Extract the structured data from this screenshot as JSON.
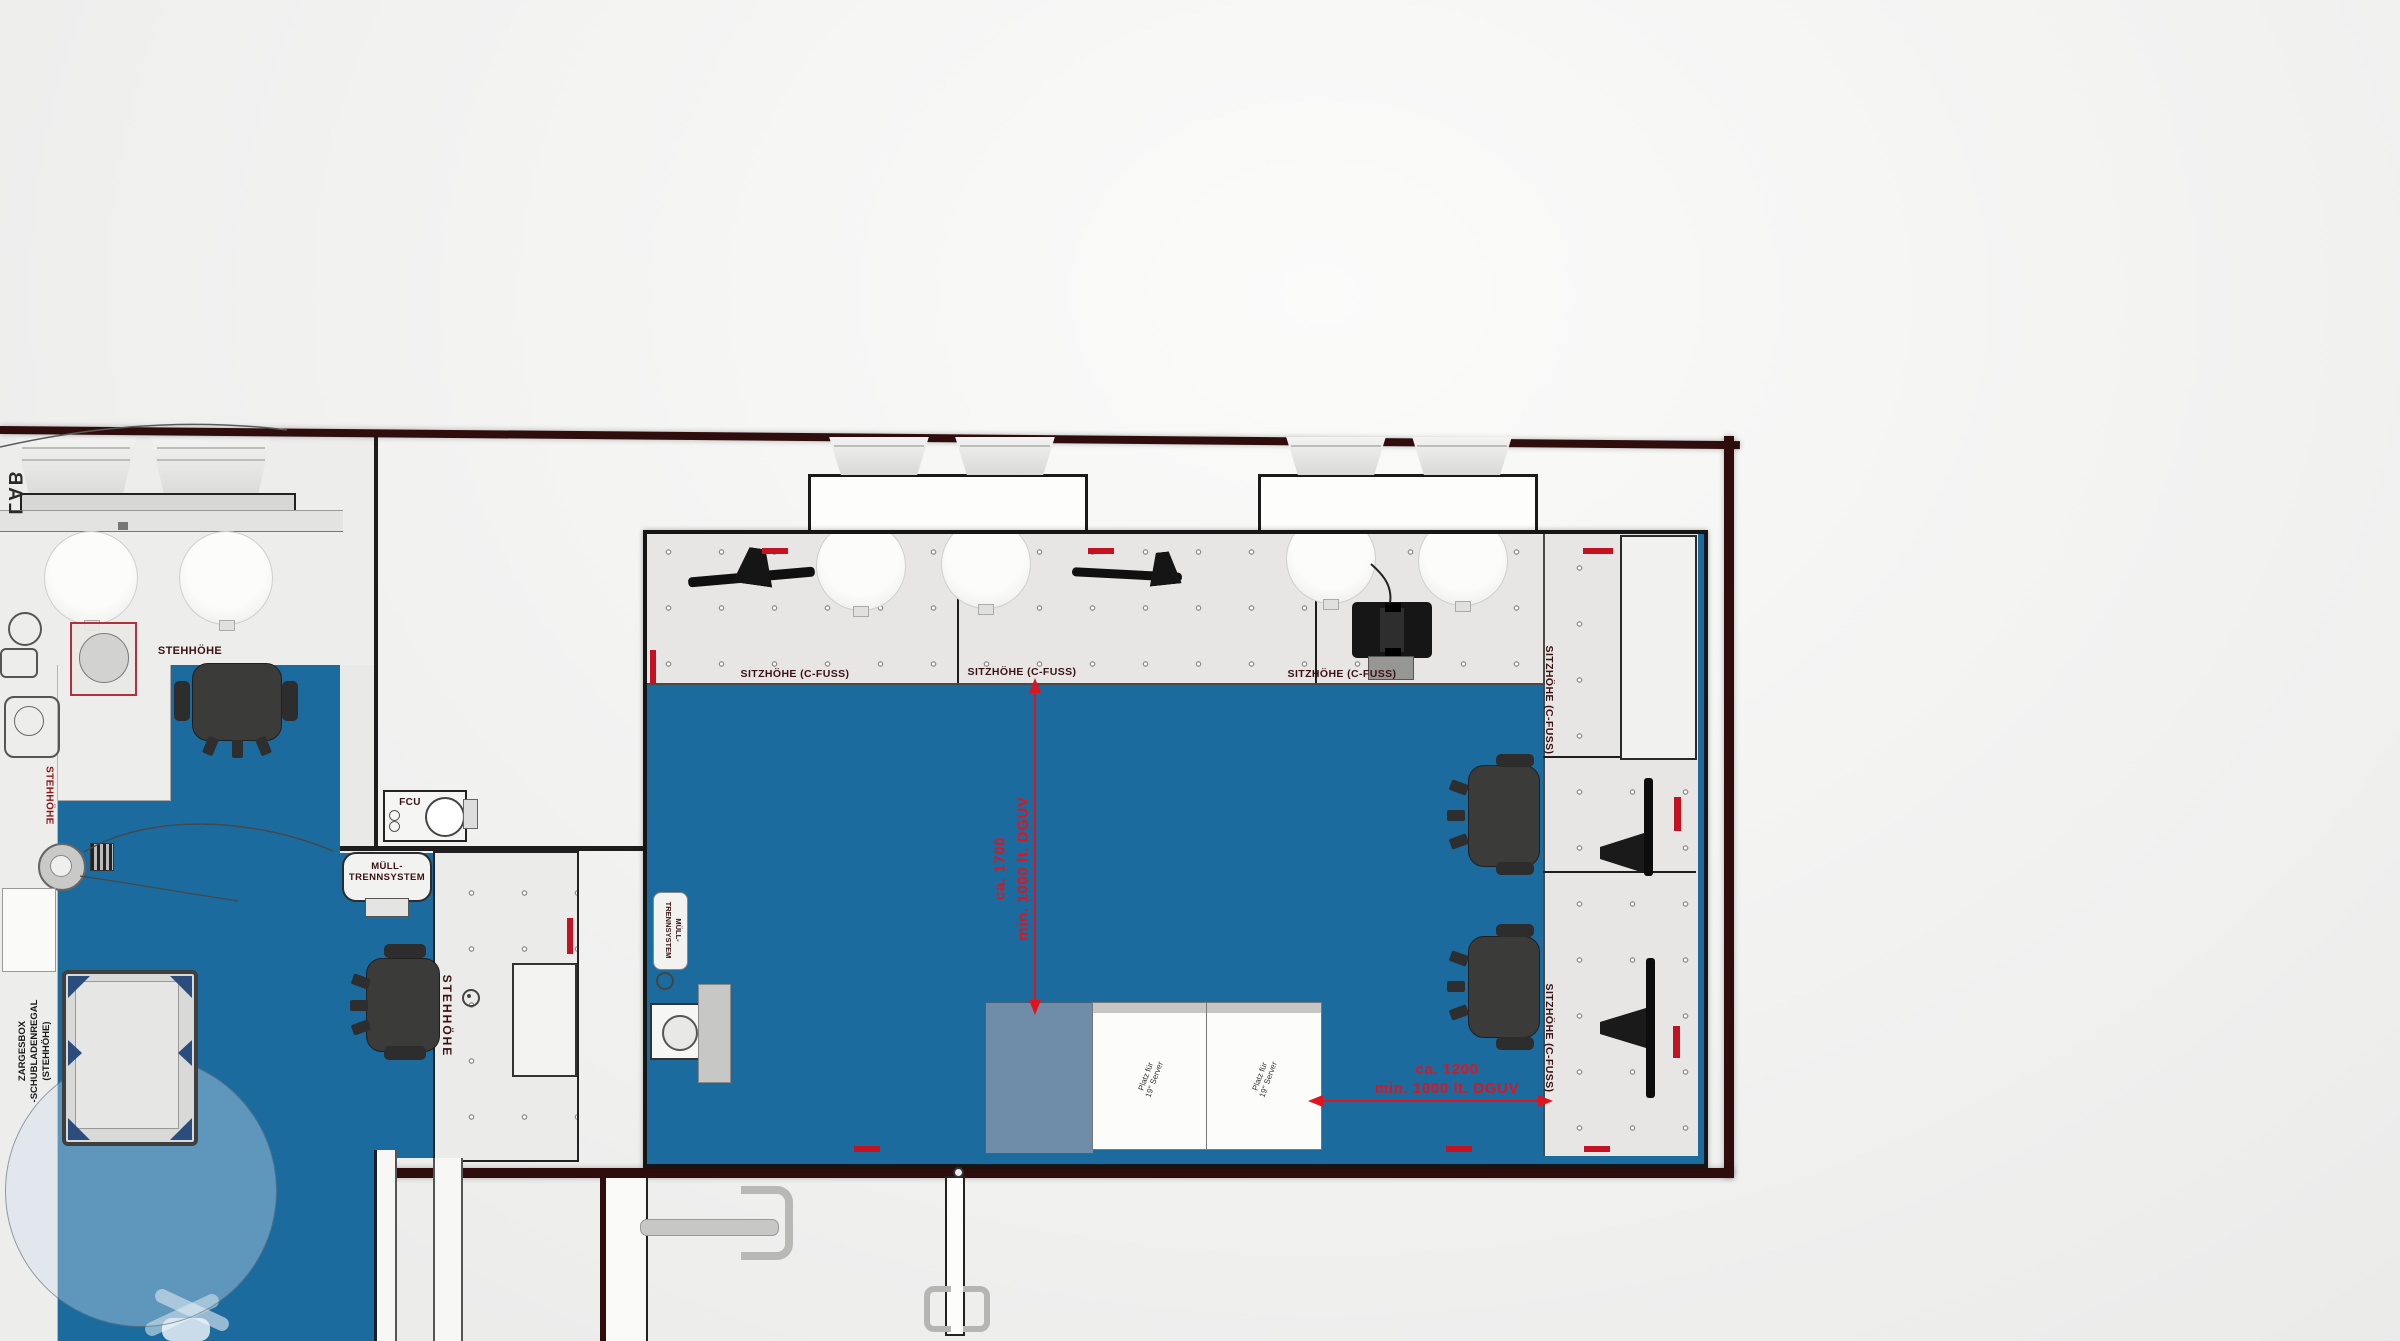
{
  "drawing": {
    "type": "floor-plan",
    "colors": {
      "floor_blue": "#1b6b9e",
      "wall_maroon": "#300d0d",
      "dimension_red": "#e0141e",
      "label_maroon": "#3b1212",
      "cabinet_steel_blue": "#6f8da9"
    },
    "labels": {
      "lab": "LAB",
      "stand_height": "STEHHÖHE",
      "seat_height": "SITZHÖHE  (C-FUSS)",
      "fcu": "FCU",
      "waste_line1": "MÜLL-",
      "waste_line2": "TRENNSYSTEM",
      "zargesbox_line1": "ZARGESBOX",
      "zargesbox_line2": "-SCHUBLADENREGAL",
      "zargesbox_line3": "(STEHHÖHE)",
      "server_rack": "Platz für\n19\" Server"
    },
    "dimensions": {
      "vertical": {
        "approx": "ca. 1700",
        "minimum": "min. 1000 lt. DGUV"
      },
      "horizontal": {
        "approx": "ca. 1200",
        "minimum": "min. 1000 lt. DGUV"
      }
    }
  }
}
